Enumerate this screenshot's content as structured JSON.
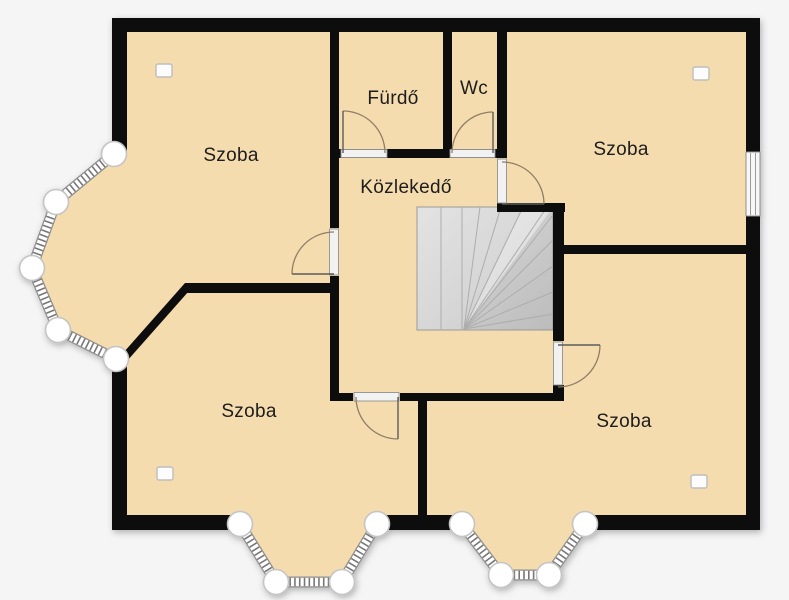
{
  "plan_type": "floor-plan",
  "language": "hu",
  "rooms": [
    {
      "id": "szoba-top-left",
      "label": "Szoba"
    },
    {
      "id": "furdo",
      "label": "Fürdő"
    },
    {
      "id": "wc",
      "label": "Wc"
    },
    {
      "id": "szoba-top-right",
      "label": "Szoba"
    },
    {
      "id": "kozlekedo",
      "label": "Közlekedő"
    },
    {
      "id": "szoba-bottom-left",
      "label": "Szoba"
    },
    {
      "id": "szoba-bottom-right",
      "label": "Szoba"
    }
  ],
  "features": {
    "stairs": {
      "present": true,
      "type": "winder",
      "location": "center"
    },
    "doors": 6,
    "wall_window": {
      "location": "right-wall-top-right-room"
    },
    "bay_windows": [
      {
        "location": "left",
        "glazed_segments": 4,
        "posts": 5
      },
      {
        "location": "bottom-left",
        "glazed_segments": 3,
        "posts": 4
      },
      {
        "location": "bottom-right",
        "glazed_segments": 3,
        "posts": 4
      }
    ],
    "fixture_markers": 4
  },
  "colors": {
    "background": "#f5f5f6",
    "floor": "#f5dcae",
    "wall": "#0a0a0a",
    "stairs": "#d9d9d9",
    "door_arc": "#8f7e68",
    "window_frame": "#8f8f8f"
  }
}
